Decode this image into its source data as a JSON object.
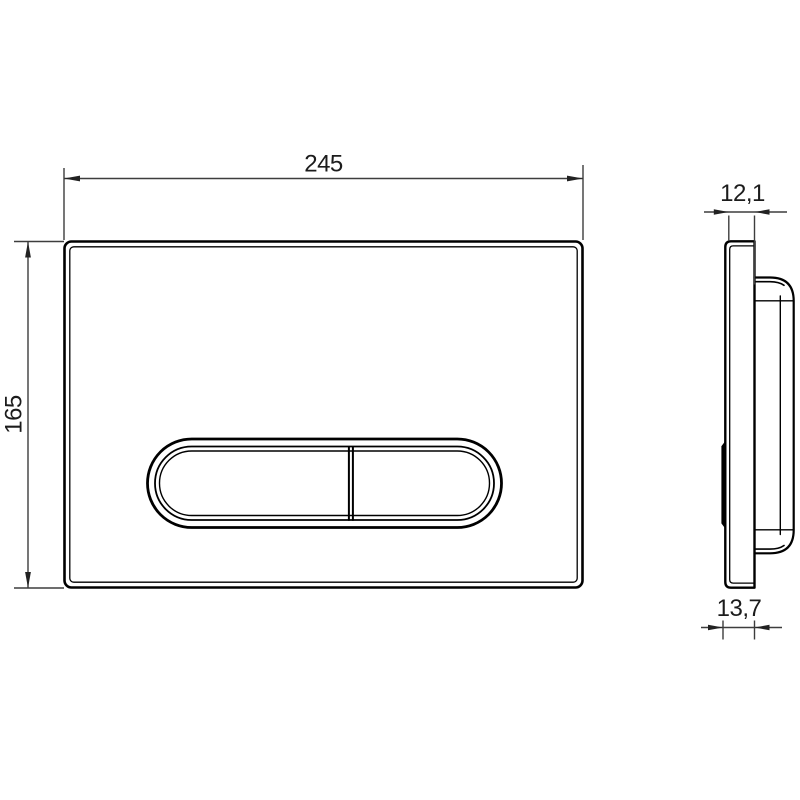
{
  "colors": {
    "background": "#ffffff",
    "object_line": "#000000",
    "dimension_line": "#3d3d3d",
    "text": "#1c1c1c"
  },
  "front_view": {
    "width_label": "245",
    "height_label": "165"
  },
  "side_view": {
    "top_thickness_label": "12,1",
    "bottom_thickness_label": "13,7"
  }
}
